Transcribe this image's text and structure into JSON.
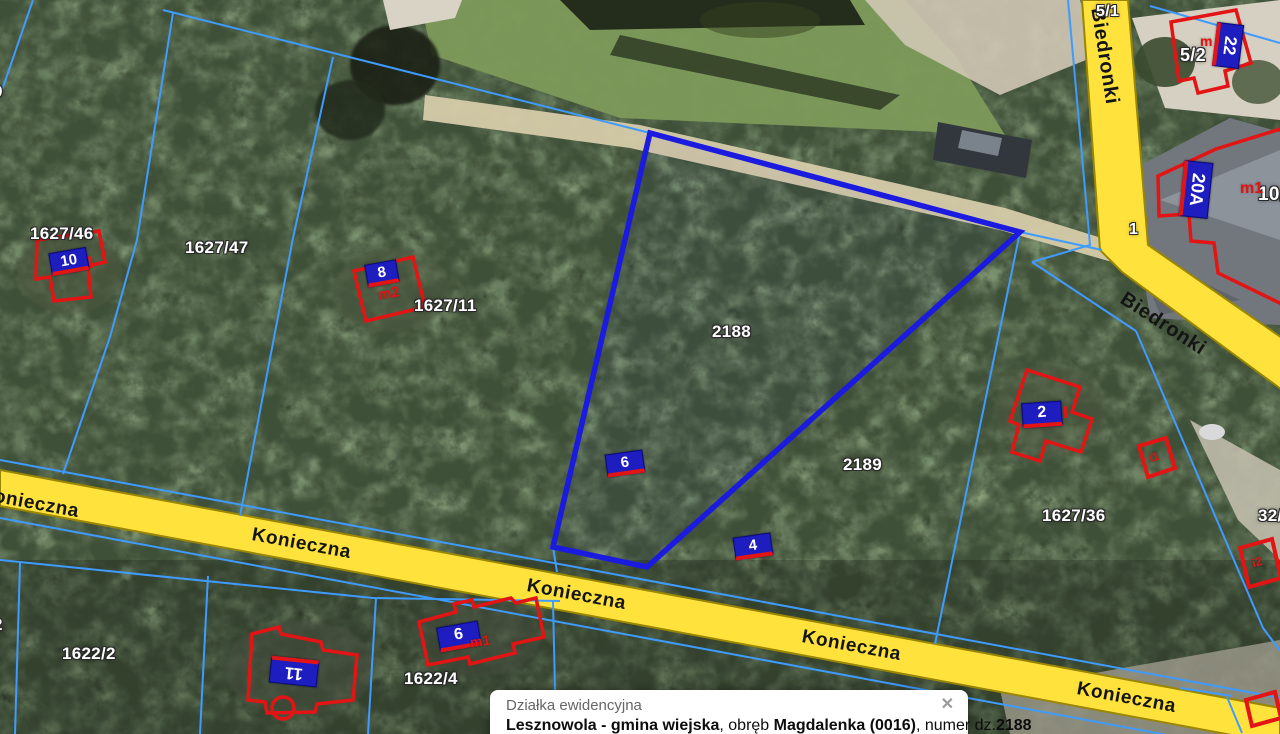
{
  "map": {
    "selected_parcel": "2188",
    "streets": {
      "konieczna": "Konieczna",
      "biedronki": "Biedronki"
    },
    "parcel_labels": {
      "p9_cut": "9",
      "p1627_46": "1627/46",
      "p1627_47": "1627/47",
      "p1627_11": "1627/11",
      "p2188": "2188",
      "p2189": "2189",
      "p1627_36": "1627/36",
      "p1622_2": "1622/2",
      "p1622_4": "1622/4",
      "p5_1": "5/1",
      "p5_2": "5/2",
      "p1": "1",
      "p10_cut": "10/",
      "p32_cut": "32/",
      "p2_cut": "2"
    },
    "address_plates": {
      "a10": "10",
      "a8": "8",
      "a6_north": "6",
      "a4": "4",
      "a2": "2",
      "a11": "11",
      "a6_south": "6",
      "a22": "22",
      "a20a": "20A"
    },
    "building_marks": {
      "m2": "m2",
      "m": "m",
      "m1_20a": "m1",
      "m1_6": "m1",
      "i1": "i1",
      "i2": "i2"
    }
  },
  "popup": {
    "title": "Działka ewidencyjna",
    "close": "✕",
    "body": {
      "bold1": "Lesznowola - gmina wiejska",
      "text1": ", obręb ",
      "bold2": "Magdalenka (0016)",
      "text2": ", numer dz.",
      "bold3": "2188"
    }
  },
  "colors": {
    "highlight_blue": "#1b1bdf",
    "parcel_line_blue": "#3f9bff",
    "building_red": "#e31414",
    "road_yellow": "#ffe33c",
    "road_edge": "#9a8600",
    "plate_blue": "#1d1dc0",
    "label_white": "#ffffff"
  }
}
